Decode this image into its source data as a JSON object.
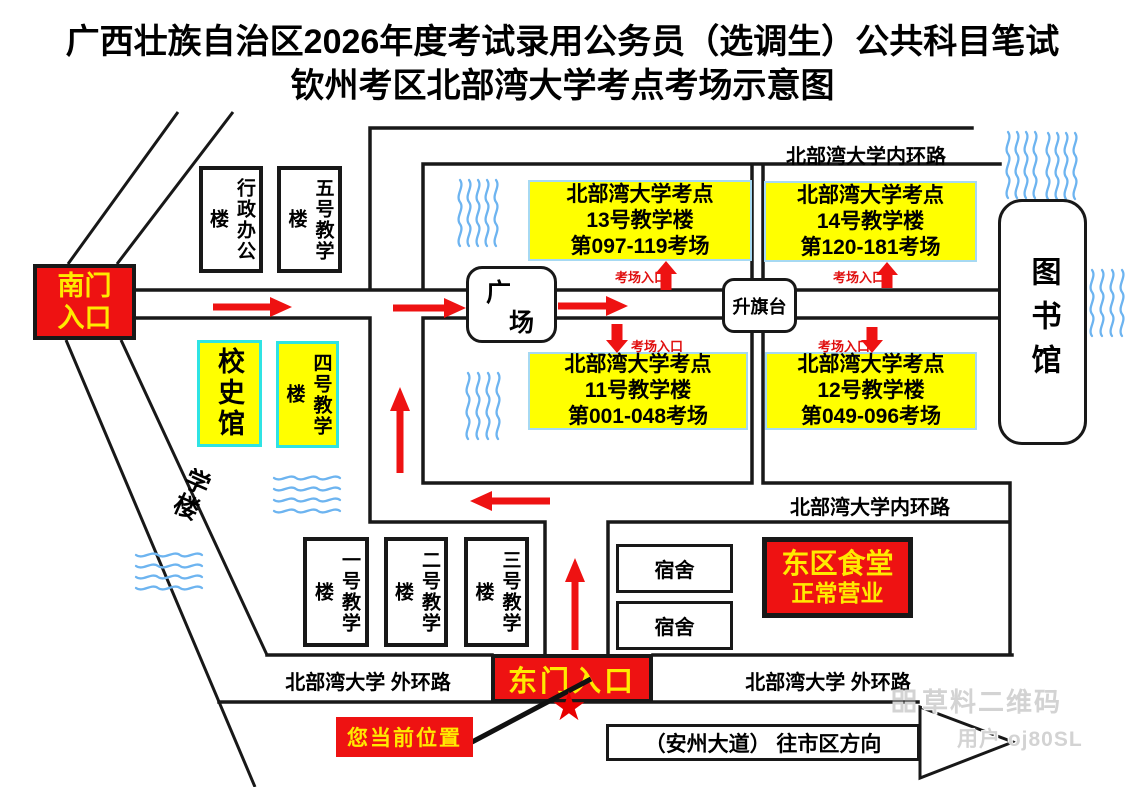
{
  "title": {
    "line1": "广西壮族自治区2026年度考试录用公务员（选调生）公共科目笔试",
    "line2": "钦州考区北部湾大学考点考场示意图"
  },
  "roads": {
    "inner_ring_top": "北部湾大学内环路",
    "inner_ring_bottom": "北部湾大学内环路",
    "outer_ring_left": "北部湾大学 外环路",
    "outer_ring_right": "北部湾大学 外环路",
    "diagonal_label": "学楼"
  },
  "gates": {
    "south_line1": "南门",
    "south_line2": "入口",
    "east": "东门入口"
  },
  "exam_buildings": [
    {
      "site": "北部湾大学考点",
      "building": "13号教学楼",
      "rooms": "第097-119考场",
      "entrance": "考场入口"
    },
    {
      "site": "北部湾大学考点",
      "building": "14号教学楼",
      "rooms": "第120-181考场",
      "entrance": "考场入口"
    },
    {
      "site": "北部湾大学考点",
      "building": "11号教学楼",
      "rooms": "第001-048考场",
      "entrance": "考场入口"
    },
    {
      "site": "北部湾大学考点",
      "building": "12号教学楼",
      "rooms": "第049-096考场",
      "entrance": "考场入口"
    }
  ],
  "buildings": {
    "admin_office": "行政办公楼",
    "teaching_no5": "五号教学楼",
    "school_history_hall": "校史馆",
    "teaching_no4": "四号教学楼",
    "teaching_no1": "一号教学楼",
    "teaching_no2": "二号教学楼",
    "teaching_no3": "三号教学楼",
    "dormitory_1": "宿舍",
    "dormitory_2": "宿舍",
    "library": "图书馆",
    "plaza_char_1": "广",
    "plaza_char_2": "场",
    "flag_platform": "升旗台",
    "canteen_line1": "东区食堂",
    "canteen_line2": "正常营业"
  },
  "annotations": {
    "current_location": "您当前位置",
    "avenue_direction": "（安州大道） 往市区方向",
    "star": "★"
  },
  "watermark": {
    "brand": "草料二维码",
    "user": "用户 oj80SL"
  },
  "colors": {
    "highlight_yellow": "#ffff00",
    "gate_red": "#ee1212",
    "arrow_red": "#ee1212",
    "cyan_border": "#2fe3e3",
    "exam_box_border": "#a6d9f2",
    "water_blue": "#6db4f0",
    "road_black": "#181818",
    "watermark_gray": "#d3d3d3"
  }
}
